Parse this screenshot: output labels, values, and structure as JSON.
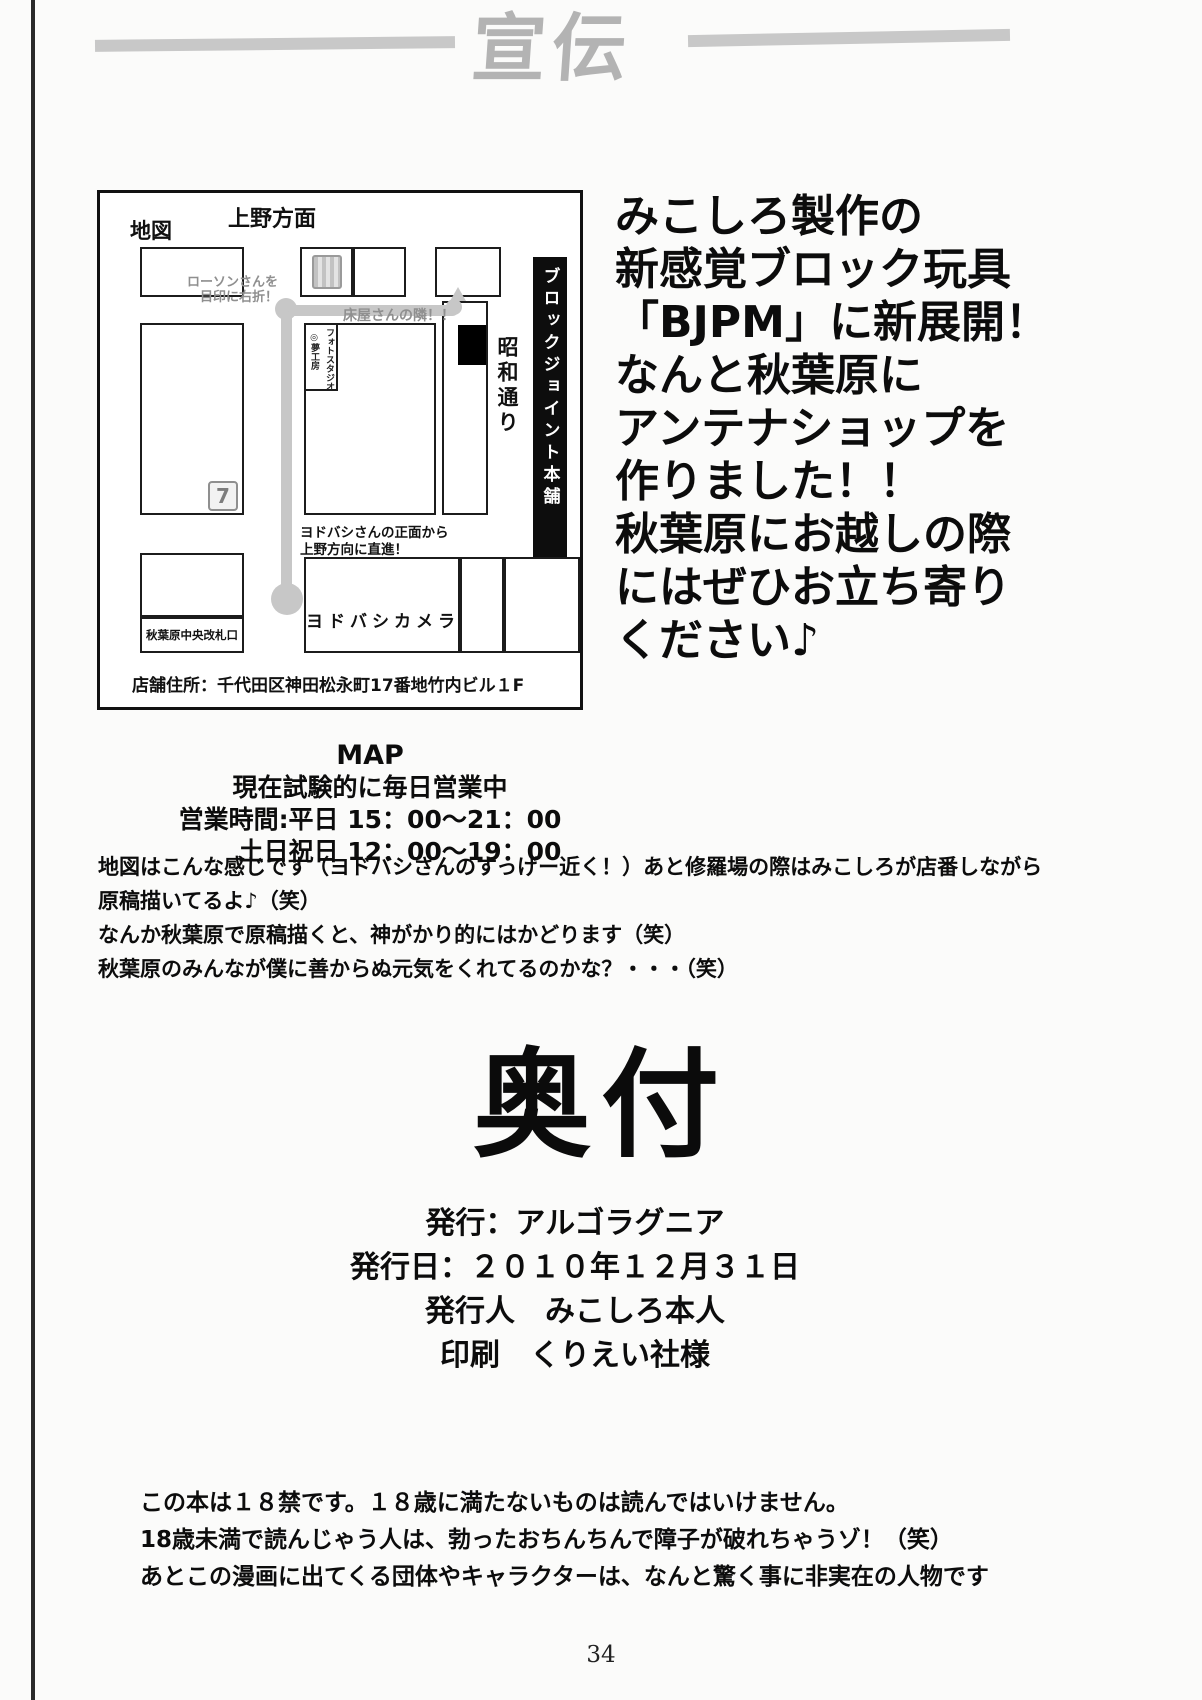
{
  "page": {
    "header_title": "宣伝",
    "page_number": "34"
  },
  "map": {
    "title_label": "地図",
    "top_label": "上野方面",
    "banner_vertical": "ブロックジョイント本舗",
    "showa_street": "昭和通り",
    "lawson_note_line1": "ローソンさんを",
    "lawson_note_line2": "目印に右折！",
    "barber_note": "床屋さんの隣！！",
    "photo_studio_col_right": "フォトスタジオ",
    "photo_studio_col_left": "◎夢工房",
    "yodobashi_note_line1": "ヨドバシさんの正面から",
    "yodobashi_note_line2": "上野方向に直進！",
    "yodobashi_label": "ヨドバシカメラ",
    "gate_label": "秋葉原中央改札口",
    "seven_logo": "7",
    "address": "店舗住所：千代田区神田松永町17番地竹内ビル１F"
  },
  "promo": {
    "lines": [
      "みこしろ製作の",
      "新感覚ブロック玩具",
      "「BJPM」に新展開！",
      "なんと秋葉原に",
      "アンテナショップを",
      "作りました！！",
      "秋葉原にお越しの際",
      "にはぜひお立ち寄り",
      "ください♪"
    ]
  },
  "map_info": {
    "heading": "MAP",
    "line1": "現在試験的に毎日営業中",
    "line2": "営業時間:平日 15：00～21：00",
    "line3": "土日祝日 12：00～19：00"
  },
  "notes": {
    "lines": [
      "地図はこんな感じです（ヨドバシさんのすっげー近く！）あと修羅場の際はみこしろが店番しながら",
      "原稿描いてるよ♪（笑）",
      "なんか秋葉原で原稿描くと、神がかり的にはかどります（笑）",
      "秋葉原のみんなが僕に善からぬ元気をくれてるのかな？・・・（笑）"
    ]
  },
  "colophon": {
    "heading": "奥付",
    "publisher": "発行：アルゴラグニア",
    "date": "発行日：２０１０年１２月３１日",
    "issuer": "発行人　みこしろ本人",
    "printer": "印刷　くりえい社様"
  },
  "disclaimer": {
    "lines": [
      "この本は１８禁です。１８歳に満たないものは読んではいけません。",
      "18歳未満で読んじゃう人は、勃ったおちんちんで障子が破れちゃうゾ！（笑）",
      "あとこの漫画に出てくる団体やキャラクターは、なんと驚く事に非実在の人物です"
    ]
  },
  "colors": {
    "accent_black": "#0d0d0d",
    "path_gray": "#c7c7c7",
    "header_gray": "#b3b3b3"
  }
}
